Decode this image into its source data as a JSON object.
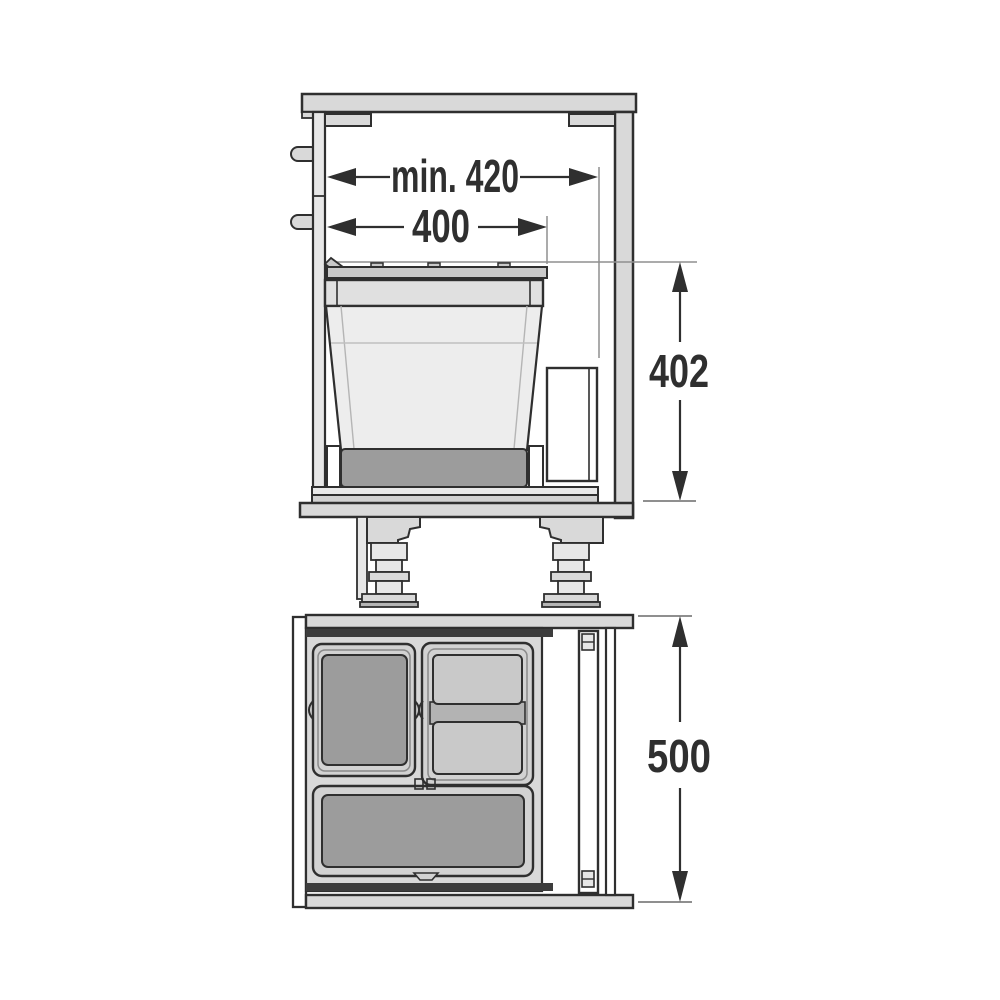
{
  "colors": {
    "line": "#2f2f2f",
    "dim_gray": "#8f8f8f",
    "paper": "#ffffff",
    "panel": "#d9d9d9",
    "panel_light": "#e7e7e7",
    "lid": "#c9c9c9",
    "rim": "#e0e0e0",
    "bin_body": "#ededed",
    "bin_inner_dark": "#9c9c9c",
    "bin_inner_light": "#c9c9c9",
    "frame_outer": "#d2d2d2",
    "tray": "#d9d9d9",
    "rail_dark": "#3d3d3d",
    "rail_light": "#e9e9e9",
    "rail_mid": "#d2d2d2",
    "divider": "#b3b3b3",
    "foot_base": "#b5b5b5",
    "hinge": "#e6e6e6"
  },
  "views": {
    "side_elevation": {
      "dimensions": {
        "opening_width_min": {
          "label": "min. 420"
        },
        "bin_width": {
          "label": "400"
        },
        "bin_height": {
          "label": "402"
        }
      }
    },
    "top_plan": {
      "dimensions": {
        "cabinet_depth": {
          "label": "500"
        }
      }
    }
  }
}
